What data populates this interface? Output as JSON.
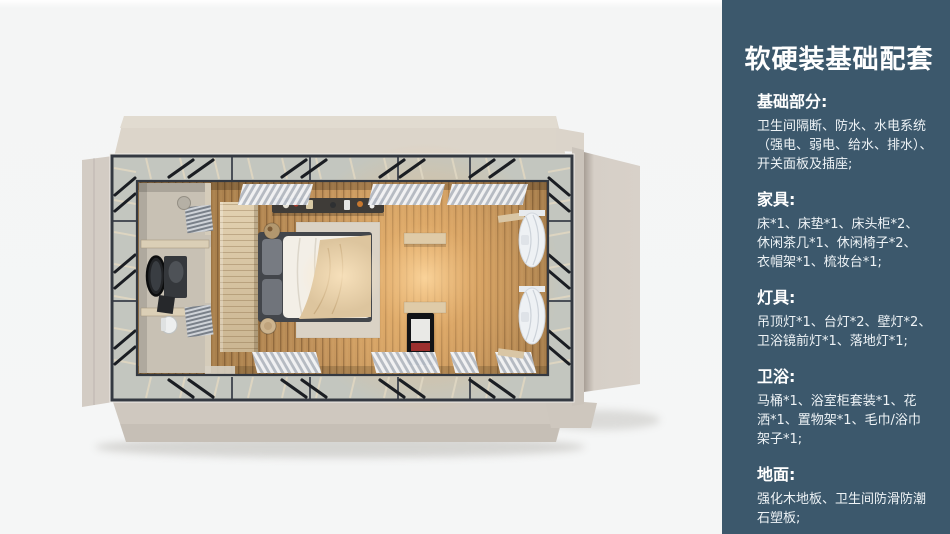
{
  "page": {
    "background": "#f5f6f6"
  },
  "sidebar": {
    "background": "#3c586c",
    "title": "软硬装基础配套",
    "title_color": "#ffffff",
    "sections": [
      {
        "heading": "基础部分:",
        "lines": [
          "卫生间隔断、防水、水电系统",
          "（强电、弱电、给水、排水）、",
          "开关面板及插座;"
        ]
      },
      {
        "heading": "家具:",
        "lines": [
          "床*1、床垫*1、床头柜*2、",
          "休闲茶几*1、休闲椅子*2、",
          "衣帽架*1、梳妆台*1;"
        ]
      },
      {
        "heading": "灯具:",
        "lines": [
          "吊顶灯*1、台灯*2、壁灯*2、",
          "卫浴镜前灯*1、落地灯*1;"
        ]
      },
      {
        "heading": "卫浴:",
        "lines": [
          "马桶*1、浴室柜套装*1、花",
          "洒*1、置物架*1、毛巾/浴巾",
          "架子*1;"
        ]
      },
      {
        "heading": "地面:",
        "lines": [
          "强化木地板、卫生间防滑防潮",
          "石塑板;"
        ]
      }
    ]
  },
  "render_palette": {
    "roof_panel": "#d8d1c8",
    "steel_frame": "#343941",
    "glass_band": "#c3c6bf",
    "wood_floor": "#c0915a",
    "warm_glow": "#ffd9a0",
    "bathroom_floor": "#c8c1b4",
    "bed_duvet": "#f3efe7",
    "bed_blanket": "#ddc59e",
    "curtain": "#f4f6f9"
  }
}
